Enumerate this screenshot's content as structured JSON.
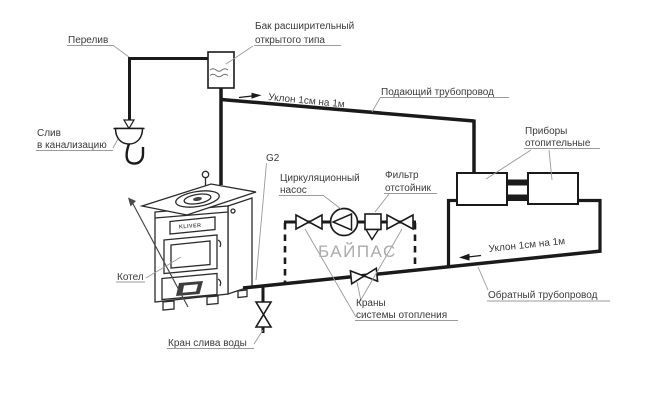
{
  "labels": {
    "overflow": "Перелив",
    "expansion_tank": {
      "line1": "Бак расширительный",
      "line2": "открытого типа"
    },
    "drain_sewer": {
      "line1": "Слив",
      "line2": "в канализацию"
    },
    "supply_slope": "Уклон 1см на 1м",
    "supply_pipe": "Подающий трубопровод",
    "heaters": {
      "line1": "Приборы",
      "line2": "отопительные"
    },
    "connection_size": "G2",
    "pump": {
      "line1": "Циркуляционный",
      "line2": "насос"
    },
    "filter": {
      "line1": "Фильтр",
      "line2": "отстойник"
    },
    "bypass": "БАЙПАС",
    "boiler": "Котел",
    "boiler_brand": "KLIVER",
    "return_slope": "Уклон 1см на 1м",
    "return_pipe": "Обратный трубопровод",
    "system_valves": {
      "line1": "Краны",
      "line2": "системы отопления"
    },
    "drain_valve_label": "Кран слива воды"
  },
  "colors": {
    "line": "#1a1a1a",
    "leader": "#9a9a9a",
    "bypass_text": "#ababab",
    "background": "#ffffff"
  }
}
